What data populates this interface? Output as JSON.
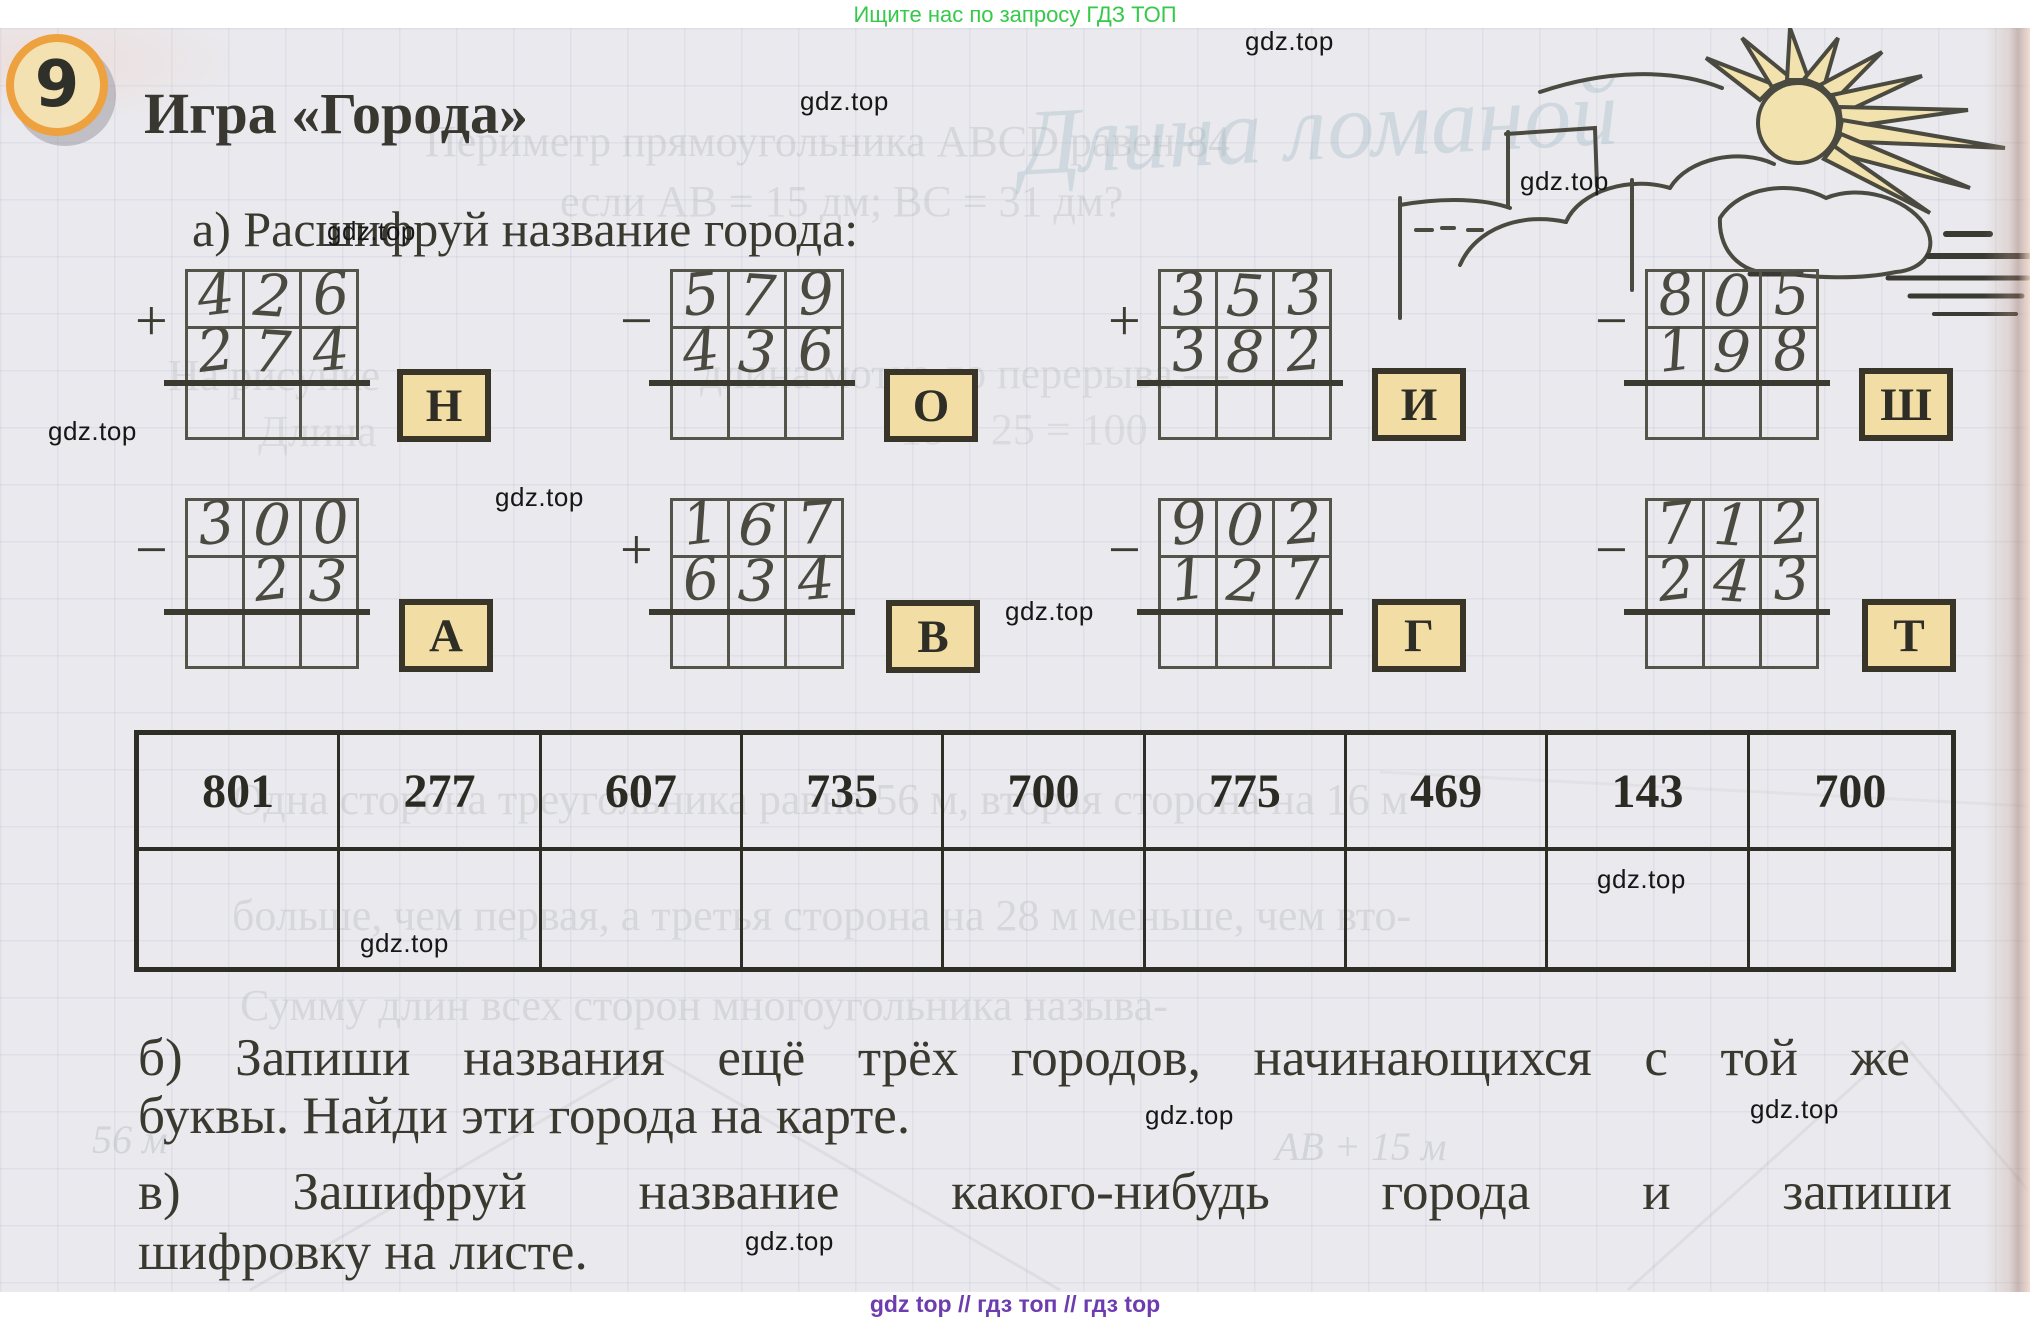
{
  "page": {
    "promo_banner": {
      "text": "Ищите нас по запросу ГДЗ ТОП",
      "color": "#35c94a"
    },
    "footer": {
      "text": "gdz top  //  гдз топ  //  гдз top",
      "color": "#6d3daf"
    },
    "watermark_text": "gdz.top",
    "colors": {
      "paper": "#eae9ed",
      "letter_box_fill": "#f2dda4",
      "badge_ring": "#eea13f",
      "badge_fill": "#f4e1b1",
      "sun_fill": "#f2e2ad"
    }
  },
  "task": {
    "number": "9",
    "title": "Игра «Города»",
    "part_a_label": "а) Расшифруй название города:",
    "part_b_line1": "б) Запиши названия ещё трёх городов, начинающихся с той же",
    "part_b_line2": "буквы. Найди эти города на карте.",
    "part_v_line1": "в) Зашифруй название какого-нибудь города и запиши",
    "part_v_line2": "шифровку на листе."
  },
  "problems": [
    {
      "op": "+",
      "top": "426",
      "bottom": "274",
      "letter": "Н"
    },
    {
      "op": "−",
      "top": "579",
      "bottom": "436",
      "letter": "О"
    },
    {
      "op": "+",
      "top": "353",
      "bottom": "382",
      "letter": "И"
    },
    {
      "op": "−",
      "top": "805",
      "bottom": "198",
      "letter": "Ш"
    },
    {
      "op": "−",
      "top": "300",
      "bottom": "23",
      "letter": "А"
    },
    {
      "op": "+",
      "top": "167",
      "bottom": "634",
      "letter": "В"
    },
    {
      "op": "−",
      "top": "902",
      "bottom": "127",
      "letter": "Г"
    },
    {
      "op": "−",
      "top": "712",
      "bottom": "243",
      "letter": "Т"
    }
  ],
  "answer_table": {
    "values": [
      "801",
      "277",
      "607",
      "735",
      "700",
      "775",
      "469",
      "143",
      "700"
    ]
  },
  "ghost_bleedthrough": [
    {
      "text": "Периметр прямоугольника ABCD равен 84"
    },
    {
      "text": "если AB = 15 дм; ВС = 31 дм?"
    },
    {
      "text": "Длина ломаной"
    },
    {
      "text": "На рисунке"
    },
    {
      "text": "длина мотка до перерыва —"
    },
    {
      "text": "Длина"
    },
    {
      "text": "18 + 25 = 100"
    },
    {
      "text": "Одна сторона треугольника равна 56 м, вторая сторона на 16 м"
    },
    {
      "text": "больше, чем первая, а третья сторона на 28 м меньше, чем вто-"
    },
    {
      "text": "Сумму длин всех сторон многоугольника называ-"
    },
    {
      "text": "56 м"
    },
    {
      "text": "АВ + 15 м"
    }
  ]
}
